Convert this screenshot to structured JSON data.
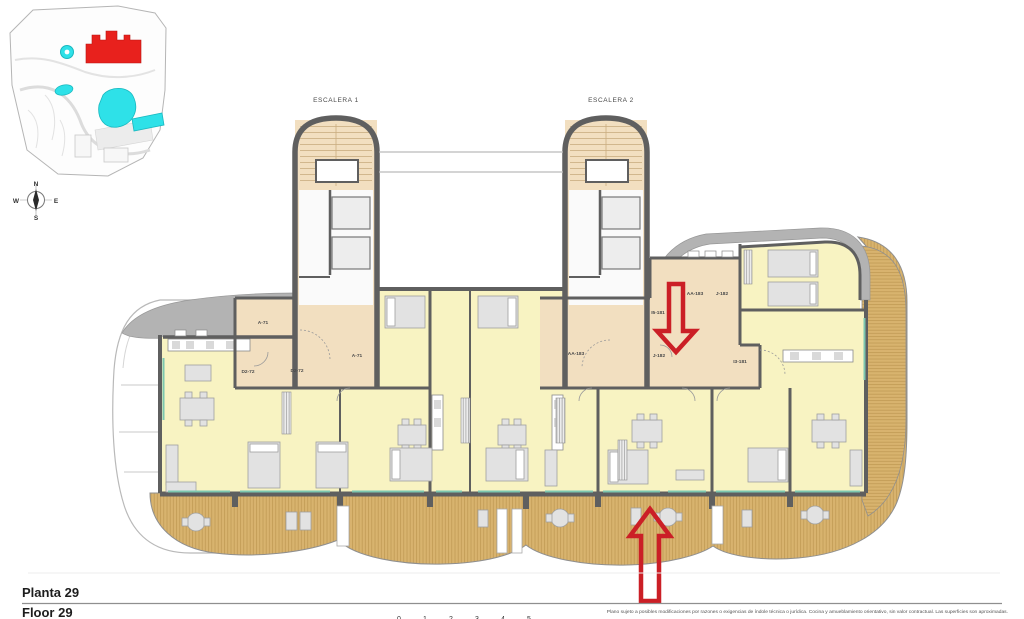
{
  "page": {
    "background": "#ffffff"
  },
  "site_inset": {
    "building_marker_color": "#e8211d",
    "pool_color": "#2ee1e8"
  },
  "compass": {
    "north": "N",
    "south": "S",
    "east": "E",
    "west": "W"
  },
  "stair_towers": [
    {
      "label": "ESCALERA 1"
    },
    {
      "label": "ESCALERA 2"
    }
  ],
  "unit_labels": [
    {
      "id": "A-71"
    },
    {
      "id": "A-71"
    },
    {
      "id": "D2-72"
    },
    {
      "id": "D2-72"
    },
    {
      "id": "AA-183"
    },
    {
      "id": "J-182"
    },
    {
      "id": "I5-181"
    },
    {
      "id": "AA-183"
    },
    {
      "id": "J-182"
    },
    {
      "id": "I3-181"
    }
  ],
  "annotations": {
    "arrow_color": "#cb1f26",
    "arrows": [
      {
        "direction": "down"
      },
      {
        "direction": "up"
      }
    ]
  },
  "palette": {
    "wall": "#5f5f5f",
    "room": "#f8f3c2",
    "corridor": "#f3dfbc",
    "deck": "#d8b36e",
    "roof_band": "#b3b3b3",
    "glass": "#7cc7b0"
  },
  "footer": {
    "title_primary": "Planta 29",
    "title_secondary": "Floor 29",
    "scale_ticks": [
      "0",
      "1",
      "2",
      "3",
      "4",
      "5"
    ],
    "disclaimer": "Plano sujeto a posibles modificaciones por razones o exigencias de índole técnica o jurídica. Cocina y amueblamiento orientativo, sin valor contractual. Las superficies son aproximadas."
  }
}
